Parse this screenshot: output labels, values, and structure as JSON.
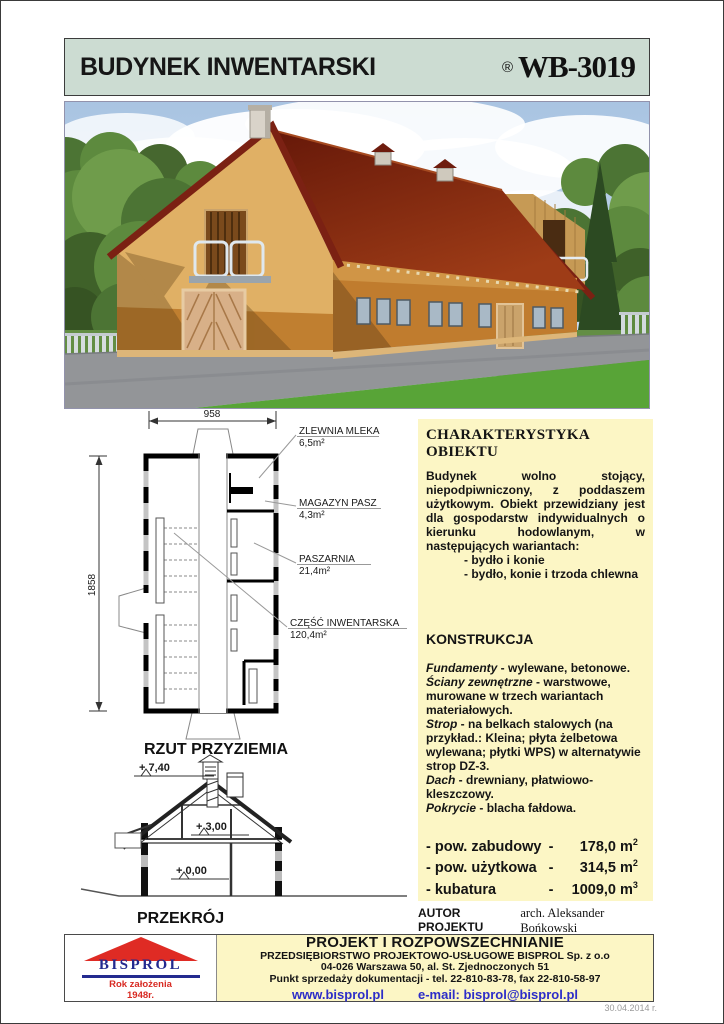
{
  "colors": {
    "header_bg": "#ccdcd2",
    "panel_bg": "#fcf6c5",
    "link_blue": "#2d2dc8",
    "logo_navy": "#232a8f",
    "logo_red": "#df2b24",
    "roof_red": "#7b2113",
    "wall_tan": "#e0b065"
  },
  "header": {
    "title": "BUDYNEK INWENTARSKI",
    "registered": "®",
    "code": "WB-3019"
  },
  "plan": {
    "caption": "RZUT PRZYZIEMIA",
    "dim_width": "958",
    "dim_height": "1858",
    "rooms": [
      {
        "name": "ZLEWNIA MLEKA",
        "area": "6,5m²"
      },
      {
        "name": "MAGAZYN PASZ",
        "area": "4,3m²"
      },
      {
        "name": "PASZARNIA",
        "area": "21,4m²"
      },
      {
        "name": "CZĘŚĆ INWENTARSKA",
        "area": "120,4m²"
      }
    ]
  },
  "section": {
    "caption": "PRZEKRÓJ",
    "levels": [
      "+ 7,40",
      "+ 3,00",
      "+ 0,00"
    ]
  },
  "characteristics": {
    "heading": "CHARAKTERYSTYKA OBIEKTU",
    "body": "Budynek wolno stojący, niepodpiwniczony, z poddaszem użytkowym. Obiekt przewidziany jest dla gospodarstw indywidualnych o kierunku hodowlanym, w następujących wariantach:",
    "variants": [
      "- bydło i konie",
      "- bydło, konie i trzoda chlewna"
    ]
  },
  "construction": {
    "heading": "KONSTRUKCJA",
    "items": [
      {
        "term": "Fundamenty",
        "desc": " - wylewane, betonowe."
      },
      {
        "term": "Ściany zewnętrzne",
        "desc": " - warstwowe, murowane w trzech wariantach materiałowych."
      },
      {
        "term": "Strop",
        "desc": " - na belkach stalowych (na przykład.: Kleina; płyta żelbetowa wylewana; płytki WPS) w alternatywie strop DZ-3."
      },
      {
        "term": "Dach",
        "desc": " - drewniany, płatwiowo-kleszczowy."
      },
      {
        "term": "Pokrycie",
        "desc": " - blacha fałdowa."
      }
    ]
  },
  "stats": [
    {
      "label": "- pow. zabudowy",
      "dash": "-",
      "value": "178,0",
      "unit": "m",
      "exp": "2"
    },
    {
      "label": "- pow. użytkowa",
      "dash": "-",
      "value": "314,5",
      "unit": "m",
      "exp": "2"
    },
    {
      "label": "- kubatura",
      "dash": "-",
      "value": "1009,0",
      "unit": "m",
      "exp": "3"
    }
  ],
  "author": {
    "label": "AUTOR PROJEKTU",
    "name": "arch. Aleksander Bońkowski"
  },
  "footer": {
    "logo": {
      "name": "BISPROL",
      "sub1": "Rok założenia",
      "sub2": "1948r."
    },
    "title": "PROJEKT I ROZPOWSZECHNIANIE",
    "line1": "PRZEDSIĘBIORSTWO PROJEKTOWO-USŁUGOWE BISPROL Sp. z o.o",
    "line2": "04-026 Warszawa 50, al. St. Zjednoczonych 51",
    "line3": "Punkt sprzedaży dokumentacji - tel. 22-810-83-78, fax 22-810-58-97",
    "website": "www.bisprol.pl",
    "email": "e-mail: bisprol@bisprol.pl"
  },
  "date": "30.04.2014 r."
}
